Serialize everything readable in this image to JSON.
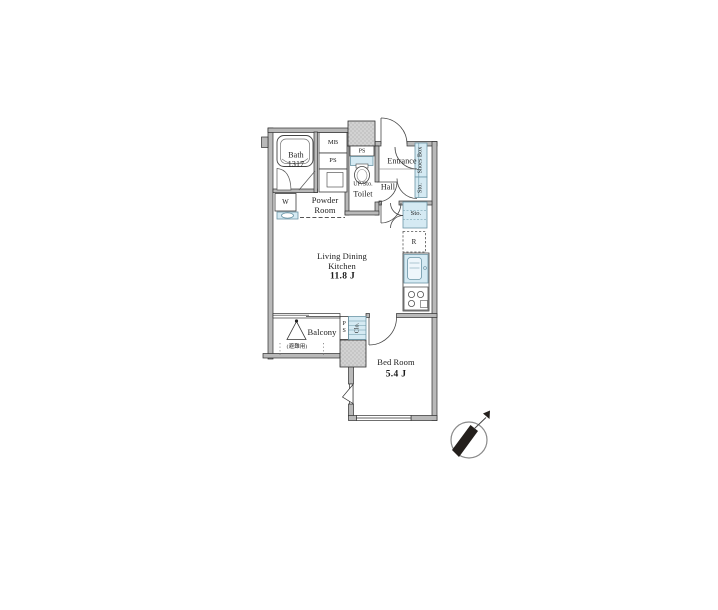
{
  "floor_plan": {
    "rooms": {
      "bath": {
        "label": "Bath\n1317"
      },
      "powder_room": {
        "label": "Powder\nRoom"
      },
      "toilet": {
        "label": "Toilet",
        "note": "UP/Sto."
      },
      "entrance": {
        "label": "Entrance"
      },
      "hall": {
        "label": "Hall"
      },
      "living_dining_kitchen": {
        "label": "Living Dining\nKitchen",
        "size": "11.8 J"
      },
      "bed_room": {
        "label": "Bed Room",
        "size": "5.4 J"
      },
      "balcony": {
        "label": "Balcony",
        "hatch_note": "(避難用)"
      }
    },
    "fixtures": {
      "meter_box": "MB",
      "pipe_shaft_upper": "PS",
      "pipe_shaft_toilet": "PS",
      "pipe_shaft_balcony": "P\nS",
      "washing_machine": "W",
      "shoes_box": "Shoes Box",
      "hall_storage": "Sto.",
      "ldk_storage": "Sto.",
      "refrigerator_space": "R",
      "closet": "Clo."
    },
    "compass_direction": "NE"
  },
  "colors": {
    "background": "#ffffff",
    "wall_fill": "#b9b9b9",
    "shaft_fill": "#d2d2d2",
    "fixture_blue": "#d5eaf3",
    "line": "#3c3c3c"
  }
}
